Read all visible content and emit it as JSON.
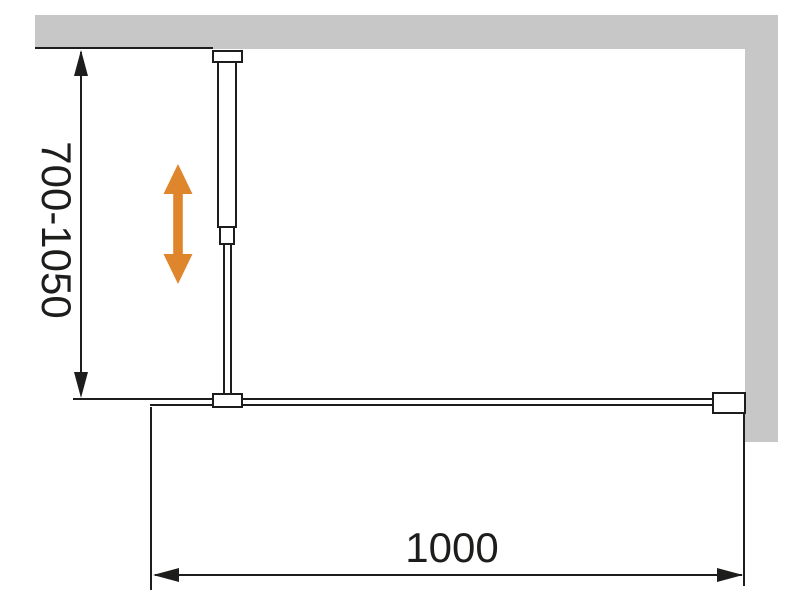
{
  "diagram": {
    "type": "technical-installation-drawing",
    "dimensions": {
      "height_range_label": "700-1050",
      "width_label": "1000"
    },
    "colors": {
      "wall_fill": "#c7c7c7",
      "line": "#1d1d1b",
      "adjust_arrow": "#df862d",
      "background": "#ffffff"
    },
    "components": {
      "wall_top": "wall section (plan/side view, top)",
      "wall_right": "wall section (right)",
      "wall_bracket_top": "wall mount bracket",
      "support_tube_upper": "upper support tube",
      "adjustment_collar": "telescopic adjustment collar",
      "support_rod_lower": "lower support rod",
      "glass_clamp": "glass panel clamp",
      "glass_panel": "glass panel edge",
      "wall_bracket_right": "wall profile bracket",
      "adjust_arrow": "vertical adjustability indicator"
    }
  }
}
